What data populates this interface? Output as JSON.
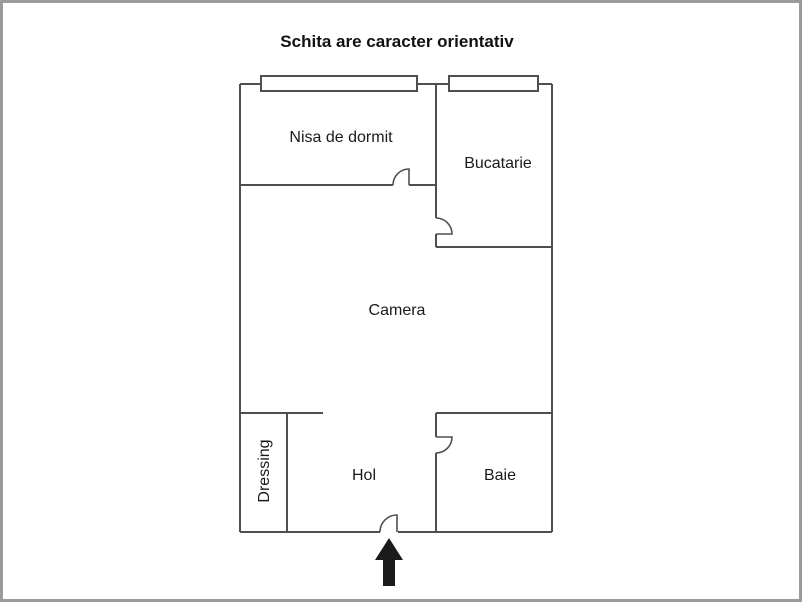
{
  "title": "Schita are caracter orientativ",
  "rooms": {
    "nisa": {
      "label": "Nisa de dormit"
    },
    "bucatarie": {
      "label": "Bucatarie"
    },
    "camera": {
      "label": "Camera"
    },
    "dressing": {
      "label": "Dressing"
    },
    "hol": {
      "label": "Hol"
    },
    "baie": {
      "label": "Baie"
    }
  },
  "symbols": {
    "entrance_arrow": "up-arrow",
    "windows_count": "2",
    "doors_count": "4"
  },
  "colors": {
    "wall": "#4f4f4f",
    "text": "#1a1a1a",
    "arrow": "#1a1a1a",
    "frame_border": "#9b9b9b",
    "background": "#ffffff"
  }
}
